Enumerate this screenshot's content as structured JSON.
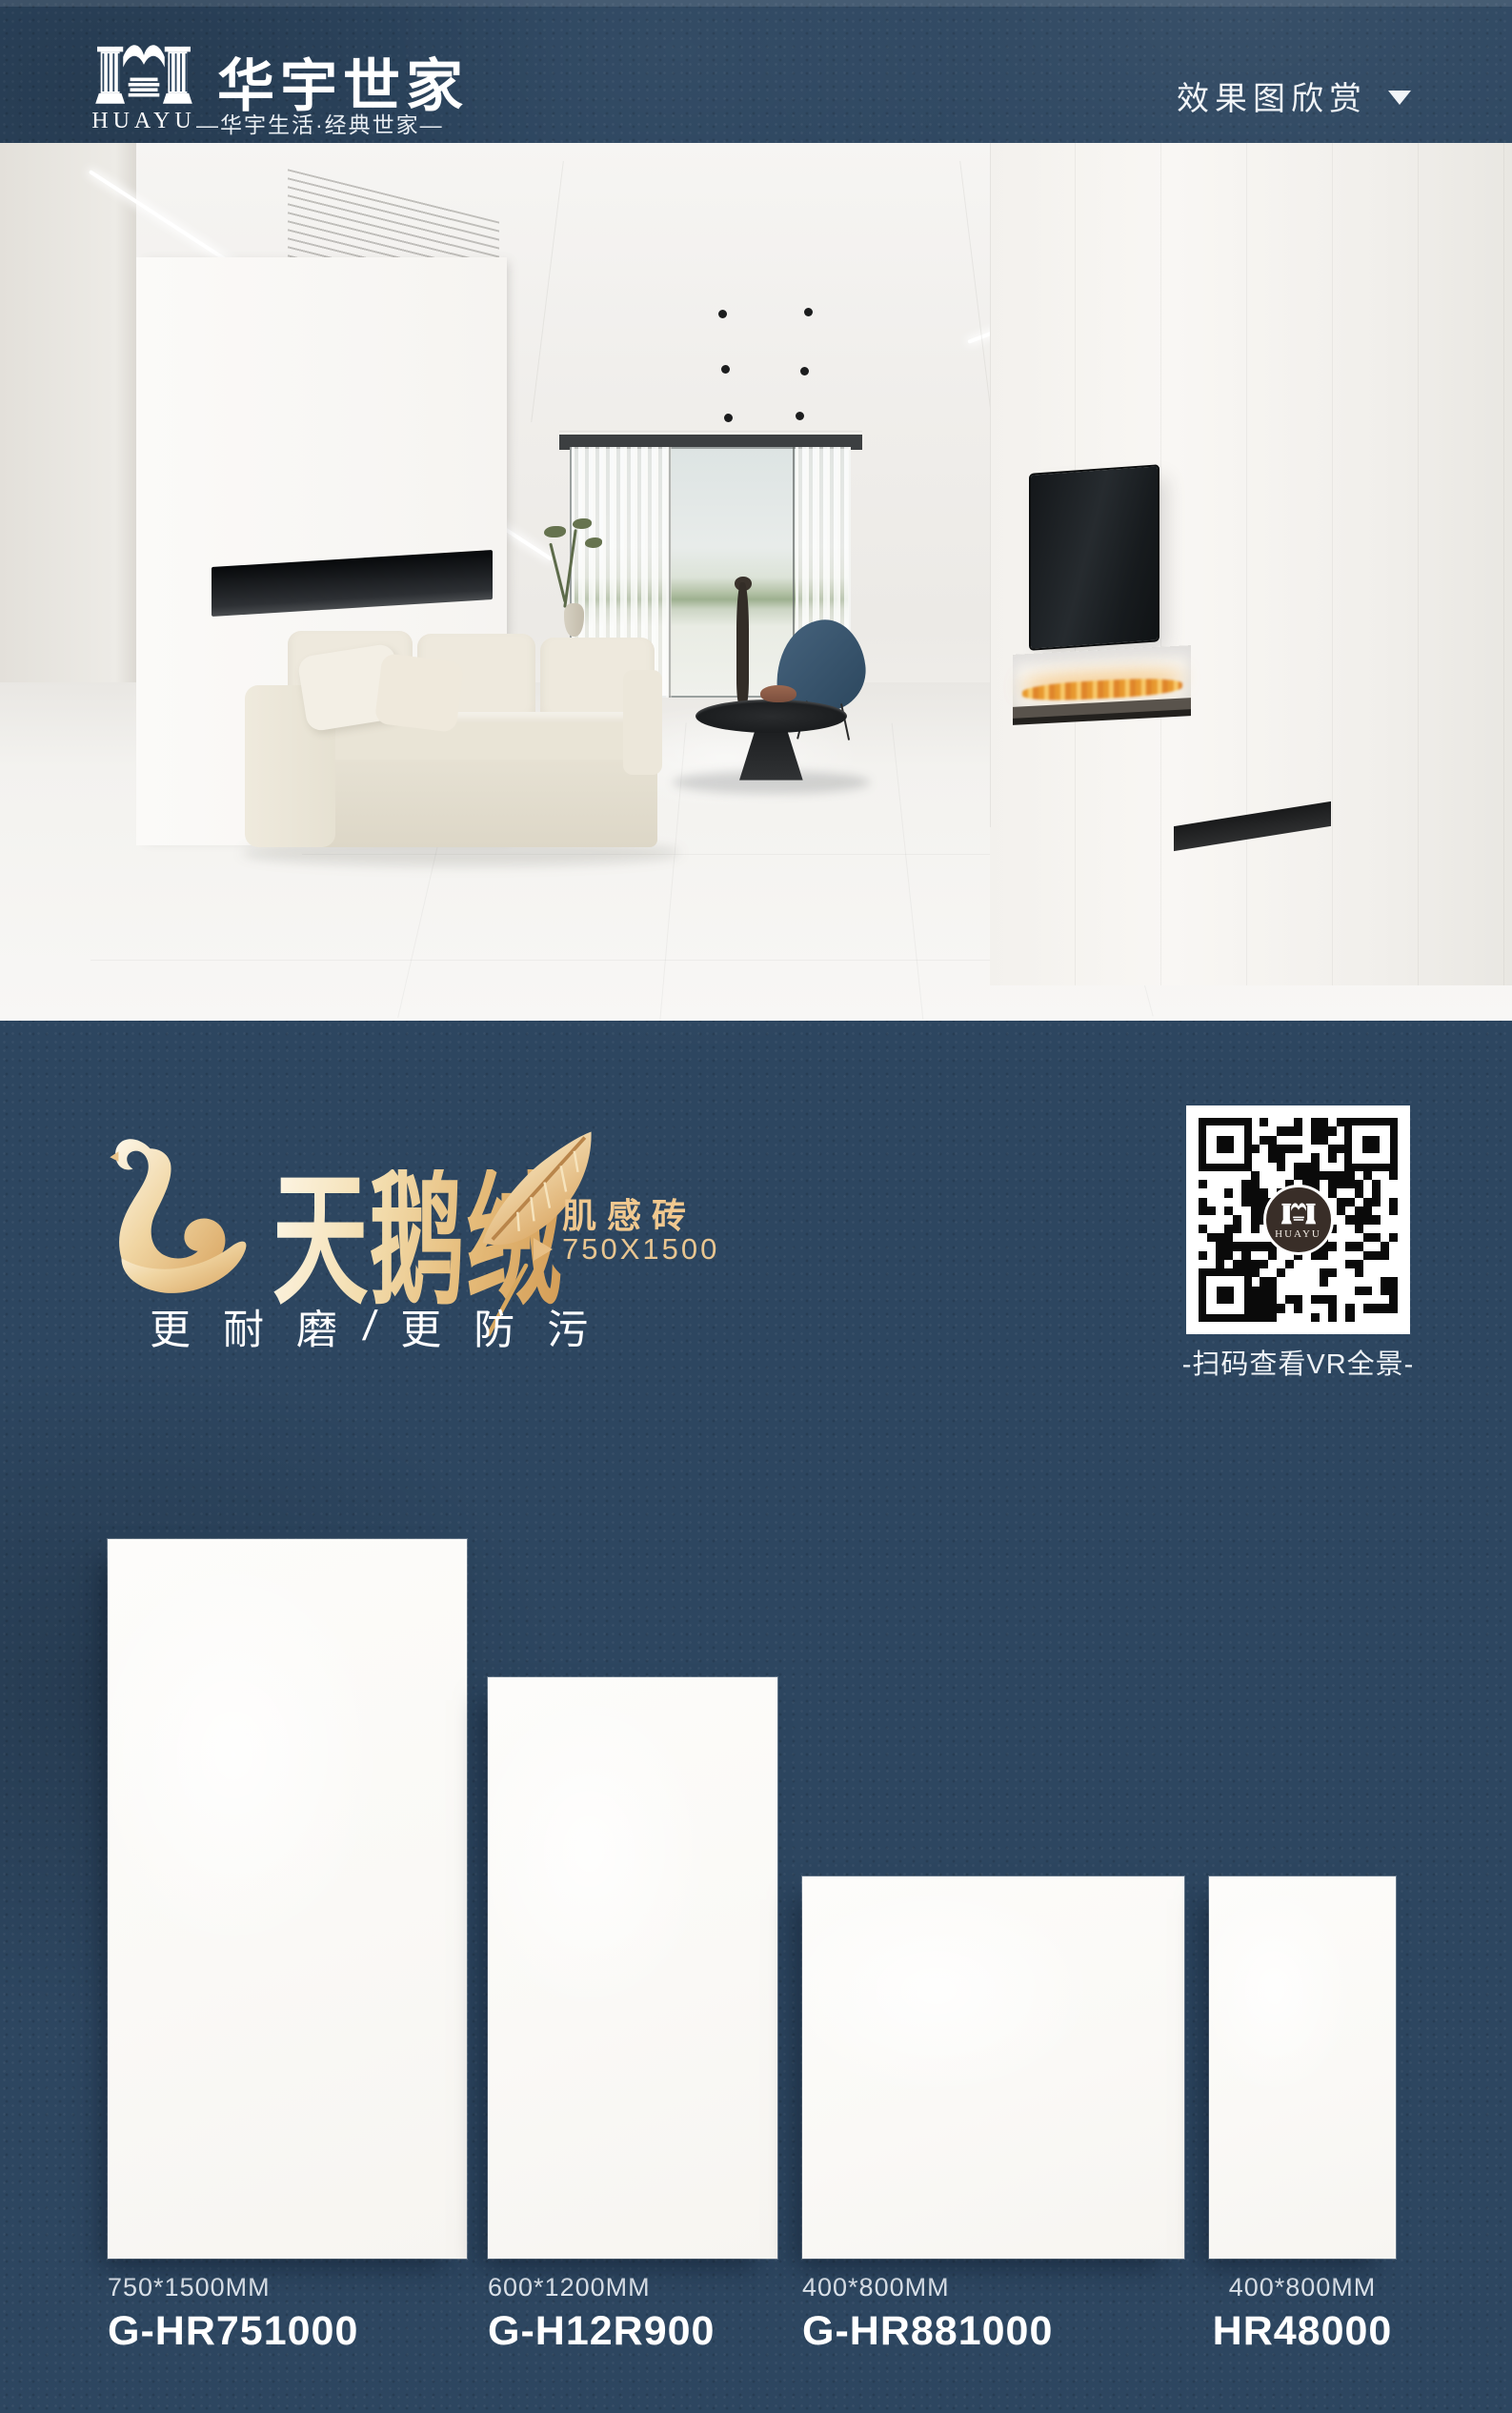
{
  "header": {
    "brand_cn": "华宇世家",
    "brand_en": "HUAYU",
    "tagline": "—华宇生活·经典世家—",
    "menu_label": "效果图欣赏"
  },
  "promo": {
    "series_title": "天鹅绒",
    "series_subtitle": "肌感砖",
    "size_tag": "750X1500",
    "slogan_left": "更耐磨",
    "slogan_divider": "/",
    "slogan_right": "更防污"
  },
  "qr": {
    "caption": "-扫码查看VR全景-",
    "logo_text": "HUAYU"
  },
  "products": [
    {
      "size": "750*1500MM",
      "model": "G-HR751000"
    },
    {
      "size": "600*1200MM",
      "model": "G-H12R900"
    },
    {
      "size": "400*800MM",
      "model": "G-HR881000"
    },
    {
      "size": "400*800MM",
      "model": "HR48000"
    }
  ],
  "colors": {
    "navy": "#2d4660",
    "gold": "#eec694",
    "gold_deep": "#d8a35e",
    "gold_light": "#f8eed6",
    "white": "#ffffff"
  }
}
